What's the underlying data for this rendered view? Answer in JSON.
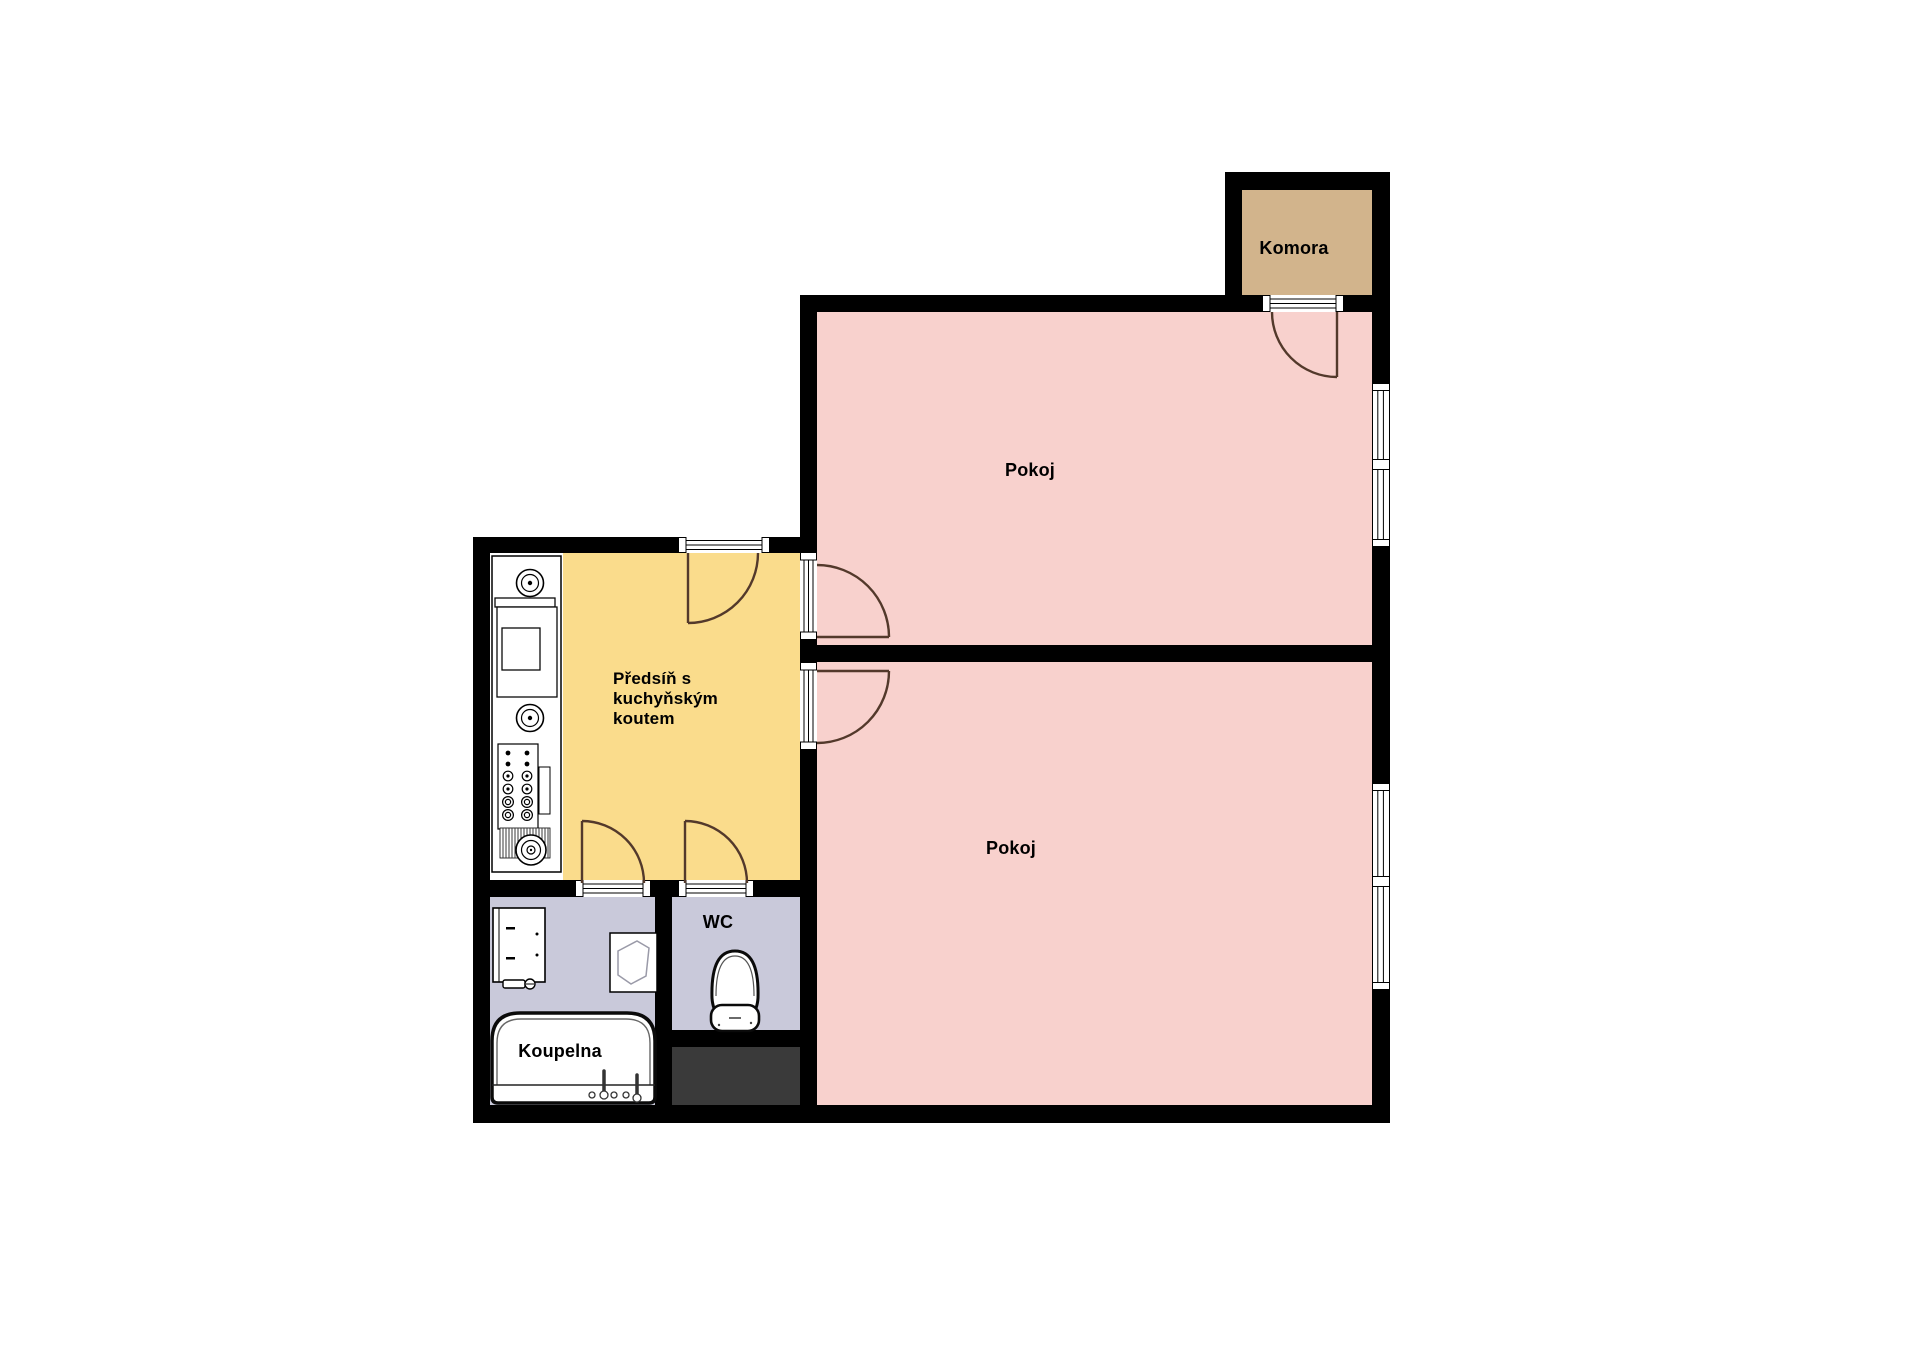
{
  "plan": {
    "type": "apartment-floor-plan",
    "rooms": [
      {
        "id": "komora",
        "label": "Komora"
      },
      {
        "id": "pokoj_top",
        "label": "Pokoj"
      },
      {
        "id": "pokoj_bottom",
        "label": "Pokoj"
      },
      {
        "id": "predsin",
        "label": "Předsíň s kuchyňským koutem"
      },
      {
        "id": "wc",
        "label": "WC"
      },
      {
        "id": "koupelna",
        "label": "Koupelna"
      }
    ],
    "fixtures": {
      "stove-burner": "concentric-circles",
      "oven": "rectangle-with-inner-square",
      "control-knobs": "dot-grid-panel",
      "radiator": "hatched-block-with-ring",
      "washbasin": "rectangle-with-tap",
      "shower-tray": "square-with-polygon",
      "bathtub": "rounded-rectangle-with-taps",
      "toilet": "egg-bowl-with-cistern",
      "installation-shaft": "dark-rectangle",
      "door-swing": "quarter-arc-with-leaf",
      "window": "striped-band-in-wall"
    },
    "colors": {
      "wall": "#000000",
      "room_pink": "#f8d1cd",
      "room_yellow": "#fadc8c",
      "room_tan": "#d2b48c",
      "room_lavender": "#c9c9da",
      "shaft_dark": "#3a3a3a",
      "door_arc": "#53392b",
      "fixture_stroke": "#0a0a0a"
    }
  }
}
